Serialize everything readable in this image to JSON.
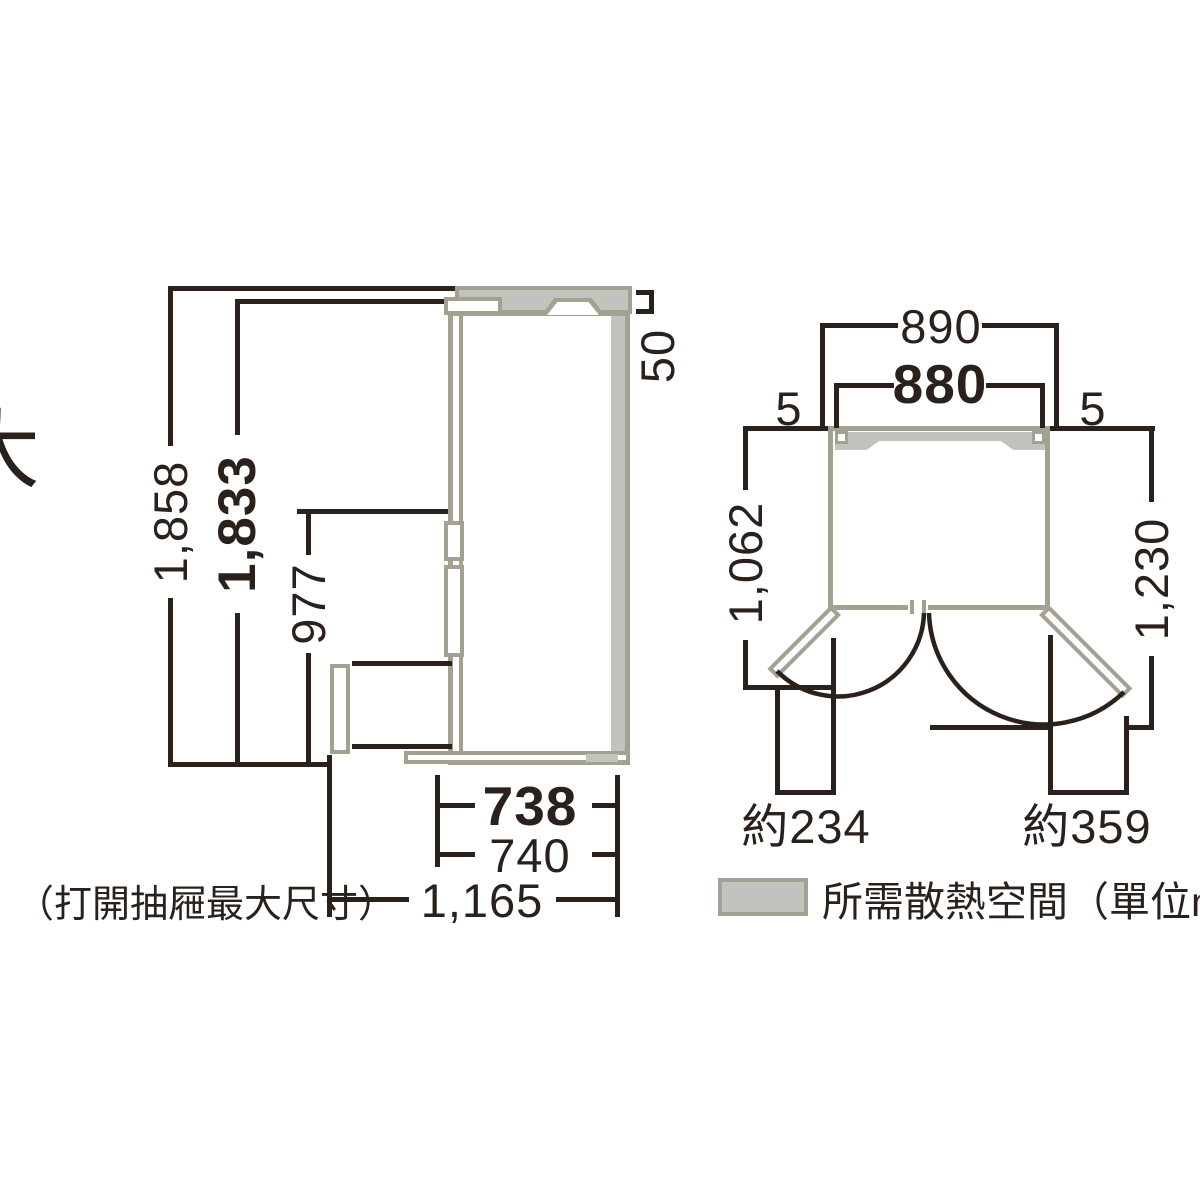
{
  "side": {
    "overall_height": "1,858",
    "body_height": "1,833",
    "lower_section_height": "977",
    "top_clearance": "50",
    "body_depth": "738",
    "door_depth": "740",
    "drawer_open_depth": "1,165",
    "note": "（打開抽屜最大尺寸）"
  },
  "top": {
    "overall_width": "890",
    "body_width": "880",
    "clearance_left": "5",
    "clearance_right": "5",
    "left_swing_depth": "1,062",
    "right_swing_depth": "1,230",
    "left_door_protrusion": "約234",
    "right_door_protrusion": "約359"
  },
  "legend": {
    "label": "所需散熱空間（單位mm）",
    "swatch_color": "#c2c2bf"
  },
  "edge_fragment": "大",
  "colors": {
    "line": "#2a211c",
    "outline": "#a2a192",
    "space_fill": "#c2c2bf"
  }
}
